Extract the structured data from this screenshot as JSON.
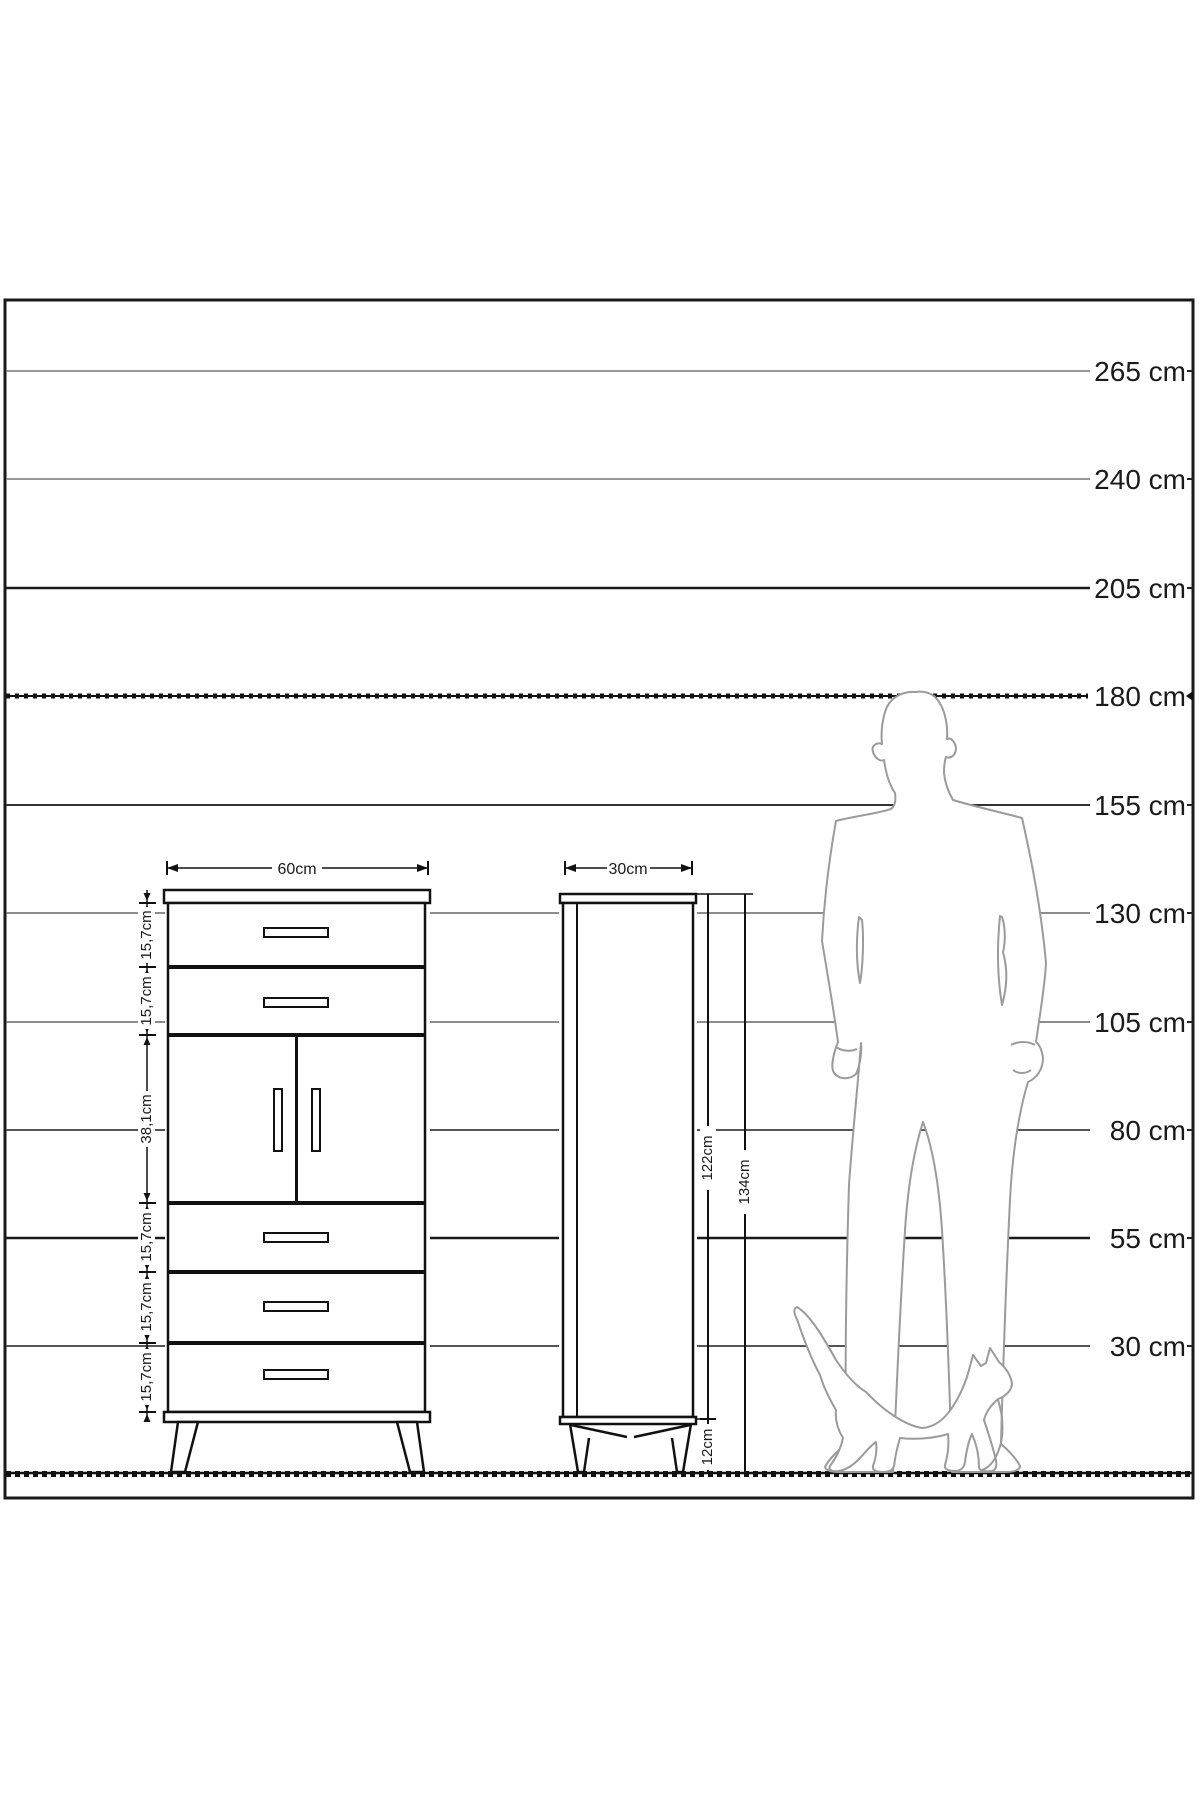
{
  "diagram": {
    "type": "furniture-dimension-diagram",
    "scale_unit": "cm",
    "scale_labels": [
      "265 cm",
      "240 cm",
      "205 cm",
      "180 cm",
      "155 cm",
      "130 cm",
      "105 cm",
      "80 cm",
      "55 cm",
      "30 cm"
    ],
    "front_view": {
      "width_label": "60cm",
      "section_labels": [
        "15,7cm",
        "15,7cm",
        "38,1cm",
        "15,7cm",
        "15,7cm",
        "15,7cm"
      ]
    },
    "side_view": {
      "depth_label": "30cm",
      "body_height_label": "122cm",
      "total_height_label": "134cm",
      "leg_height_label": "12cm"
    }
  }
}
